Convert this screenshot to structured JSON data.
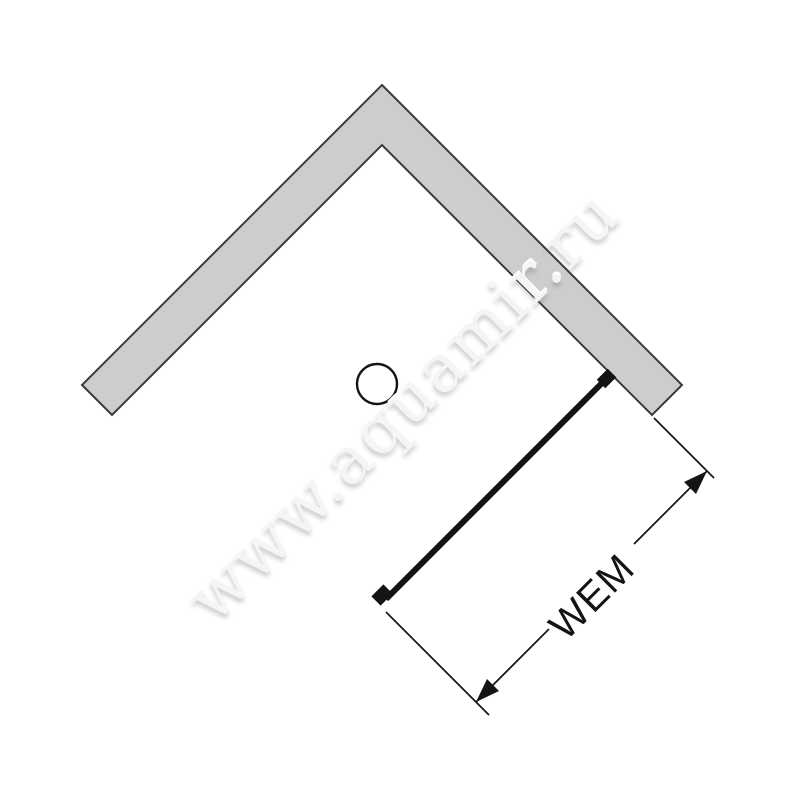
{
  "watermark": {
    "text": "www.aquamir.ru"
  },
  "dimension": {
    "label": "WEM"
  },
  "colors": {
    "background": "#ffffff",
    "wall_fill": "#cdcdcd",
    "wall_stroke": "#3a3a3a",
    "line": "#141414",
    "watermark_text": "#f5f5f5"
  }
}
